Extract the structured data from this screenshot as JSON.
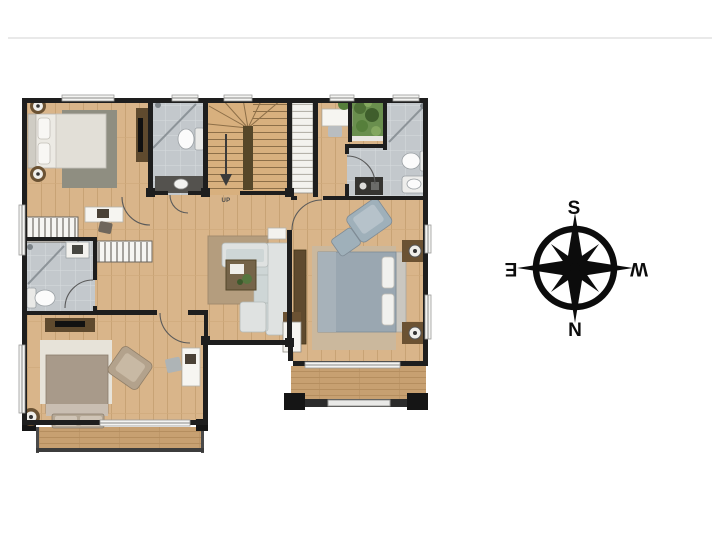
{
  "figure": {
    "type": "floor-plan-with-compass"
  },
  "compass": {
    "south": "S",
    "north": "N",
    "east": "E",
    "west": "W"
  },
  "staircase": {
    "label": "UP"
  },
  "rooms": [
    "bedroom-top-left",
    "bathroom-top",
    "staircase",
    "linen-closet",
    "planter",
    "bathroom-top-right",
    "master-bedroom",
    "living-area",
    "bathroom-left",
    "bedroom-bottom-left",
    "balcony-bottom-left",
    "balcony-bottom-right",
    "hallway"
  ],
  "palette": {
    "wall": "#1e1e1e",
    "wood_floor": "#d9b58a",
    "wood_seam": "#c8a375",
    "tile": "#c3c8cc",
    "stair_wood": "#d8b07e",
    "balcony_deck": "#c7a071",
    "rug_living": "#b49d7e",
    "rug_master": "#cbb89d",
    "rug_guest": "#e7e3d9",
    "rug_bed1": "#8f8e81",
    "sofa_white": "#dfe2e1",
    "bed_master_gray": "#9aa7b1",
    "bed_guest_brown": "#a89a8a",
    "furniture_dark_wood": "#5f4a2e",
    "plant_green": "#567f3b",
    "fixture_white": "#fbfbfb",
    "compass_black": "#0c0c0c"
  }
}
